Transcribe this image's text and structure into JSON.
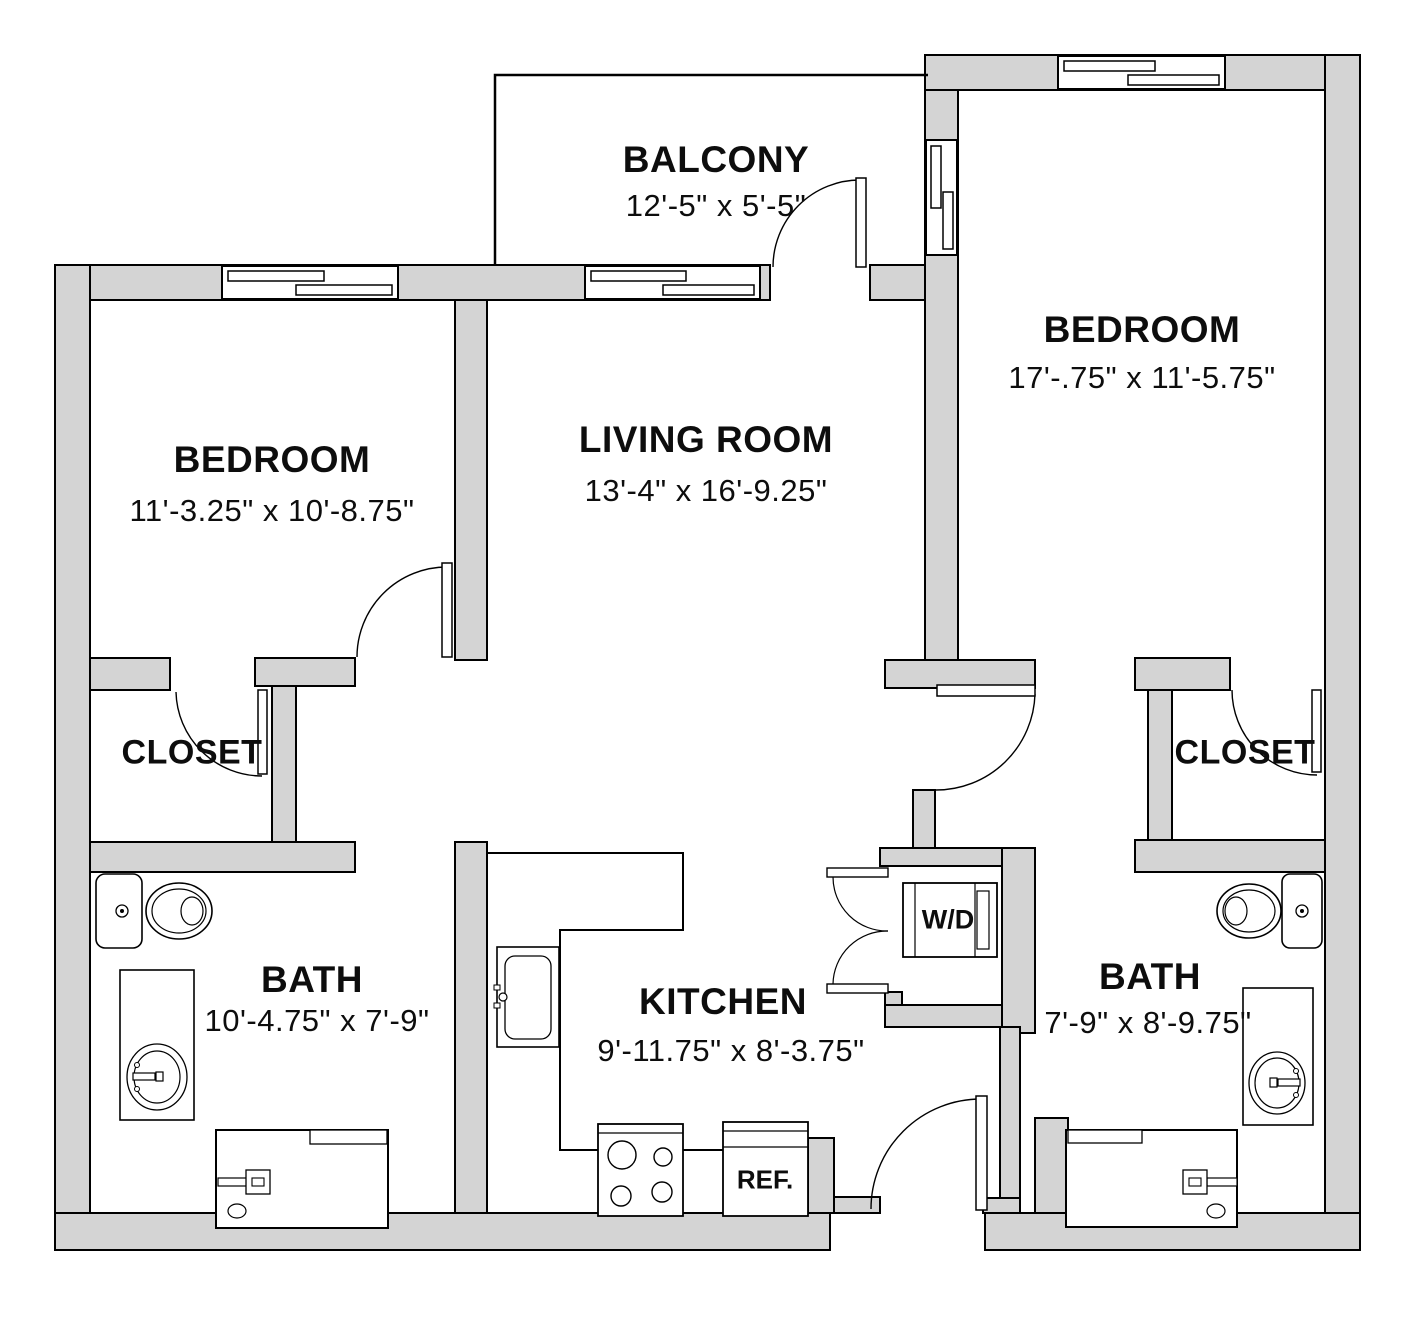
{
  "floor_plan": {
    "colors": {
      "background": "#ffffff",
      "wall_fill": "#d4d4d4",
      "line": "#000000"
    },
    "rooms": {
      "balcony": {
        "name": "BALCONY",
        "dims": "12'-5\" x 5'-5\""
      },
      "bedroom_left": {
        "name": "BEDROOM",
        "dims": "11'-3.25\" x 10'-8.75\""
      },
      "living_room": {
        "name": "LIVING ROOM",
        "dims": "13'-4\" x 16'-9.25\""
      },
      "bedroom_right": {
        "name": "BEDROOM",
        "dims": "17'-.75\" x 11'-5.75\""
      },
      "closet_left": {
        "name": "CLOSET"
      },
      "closet_right": {
        "name": "CLOSET"
      },
      "bath_left": {
        "name": "BATH",
        "dims": "10'-4.75\" x 7'-9\""
      },
      "kitchen": {
        "name": "KITCHEN",
        "dims": "9'-11.75\" x 8'-3.75\""
      },
      "bath_right": {
        "name": "BATH",
        "dims": "7'-9\" x 8'-9.75\""
      }
    },
    "appliances": {
      "washer_dryer": "W/D",
      "refrigerator": "REF."
    }
  }
}
